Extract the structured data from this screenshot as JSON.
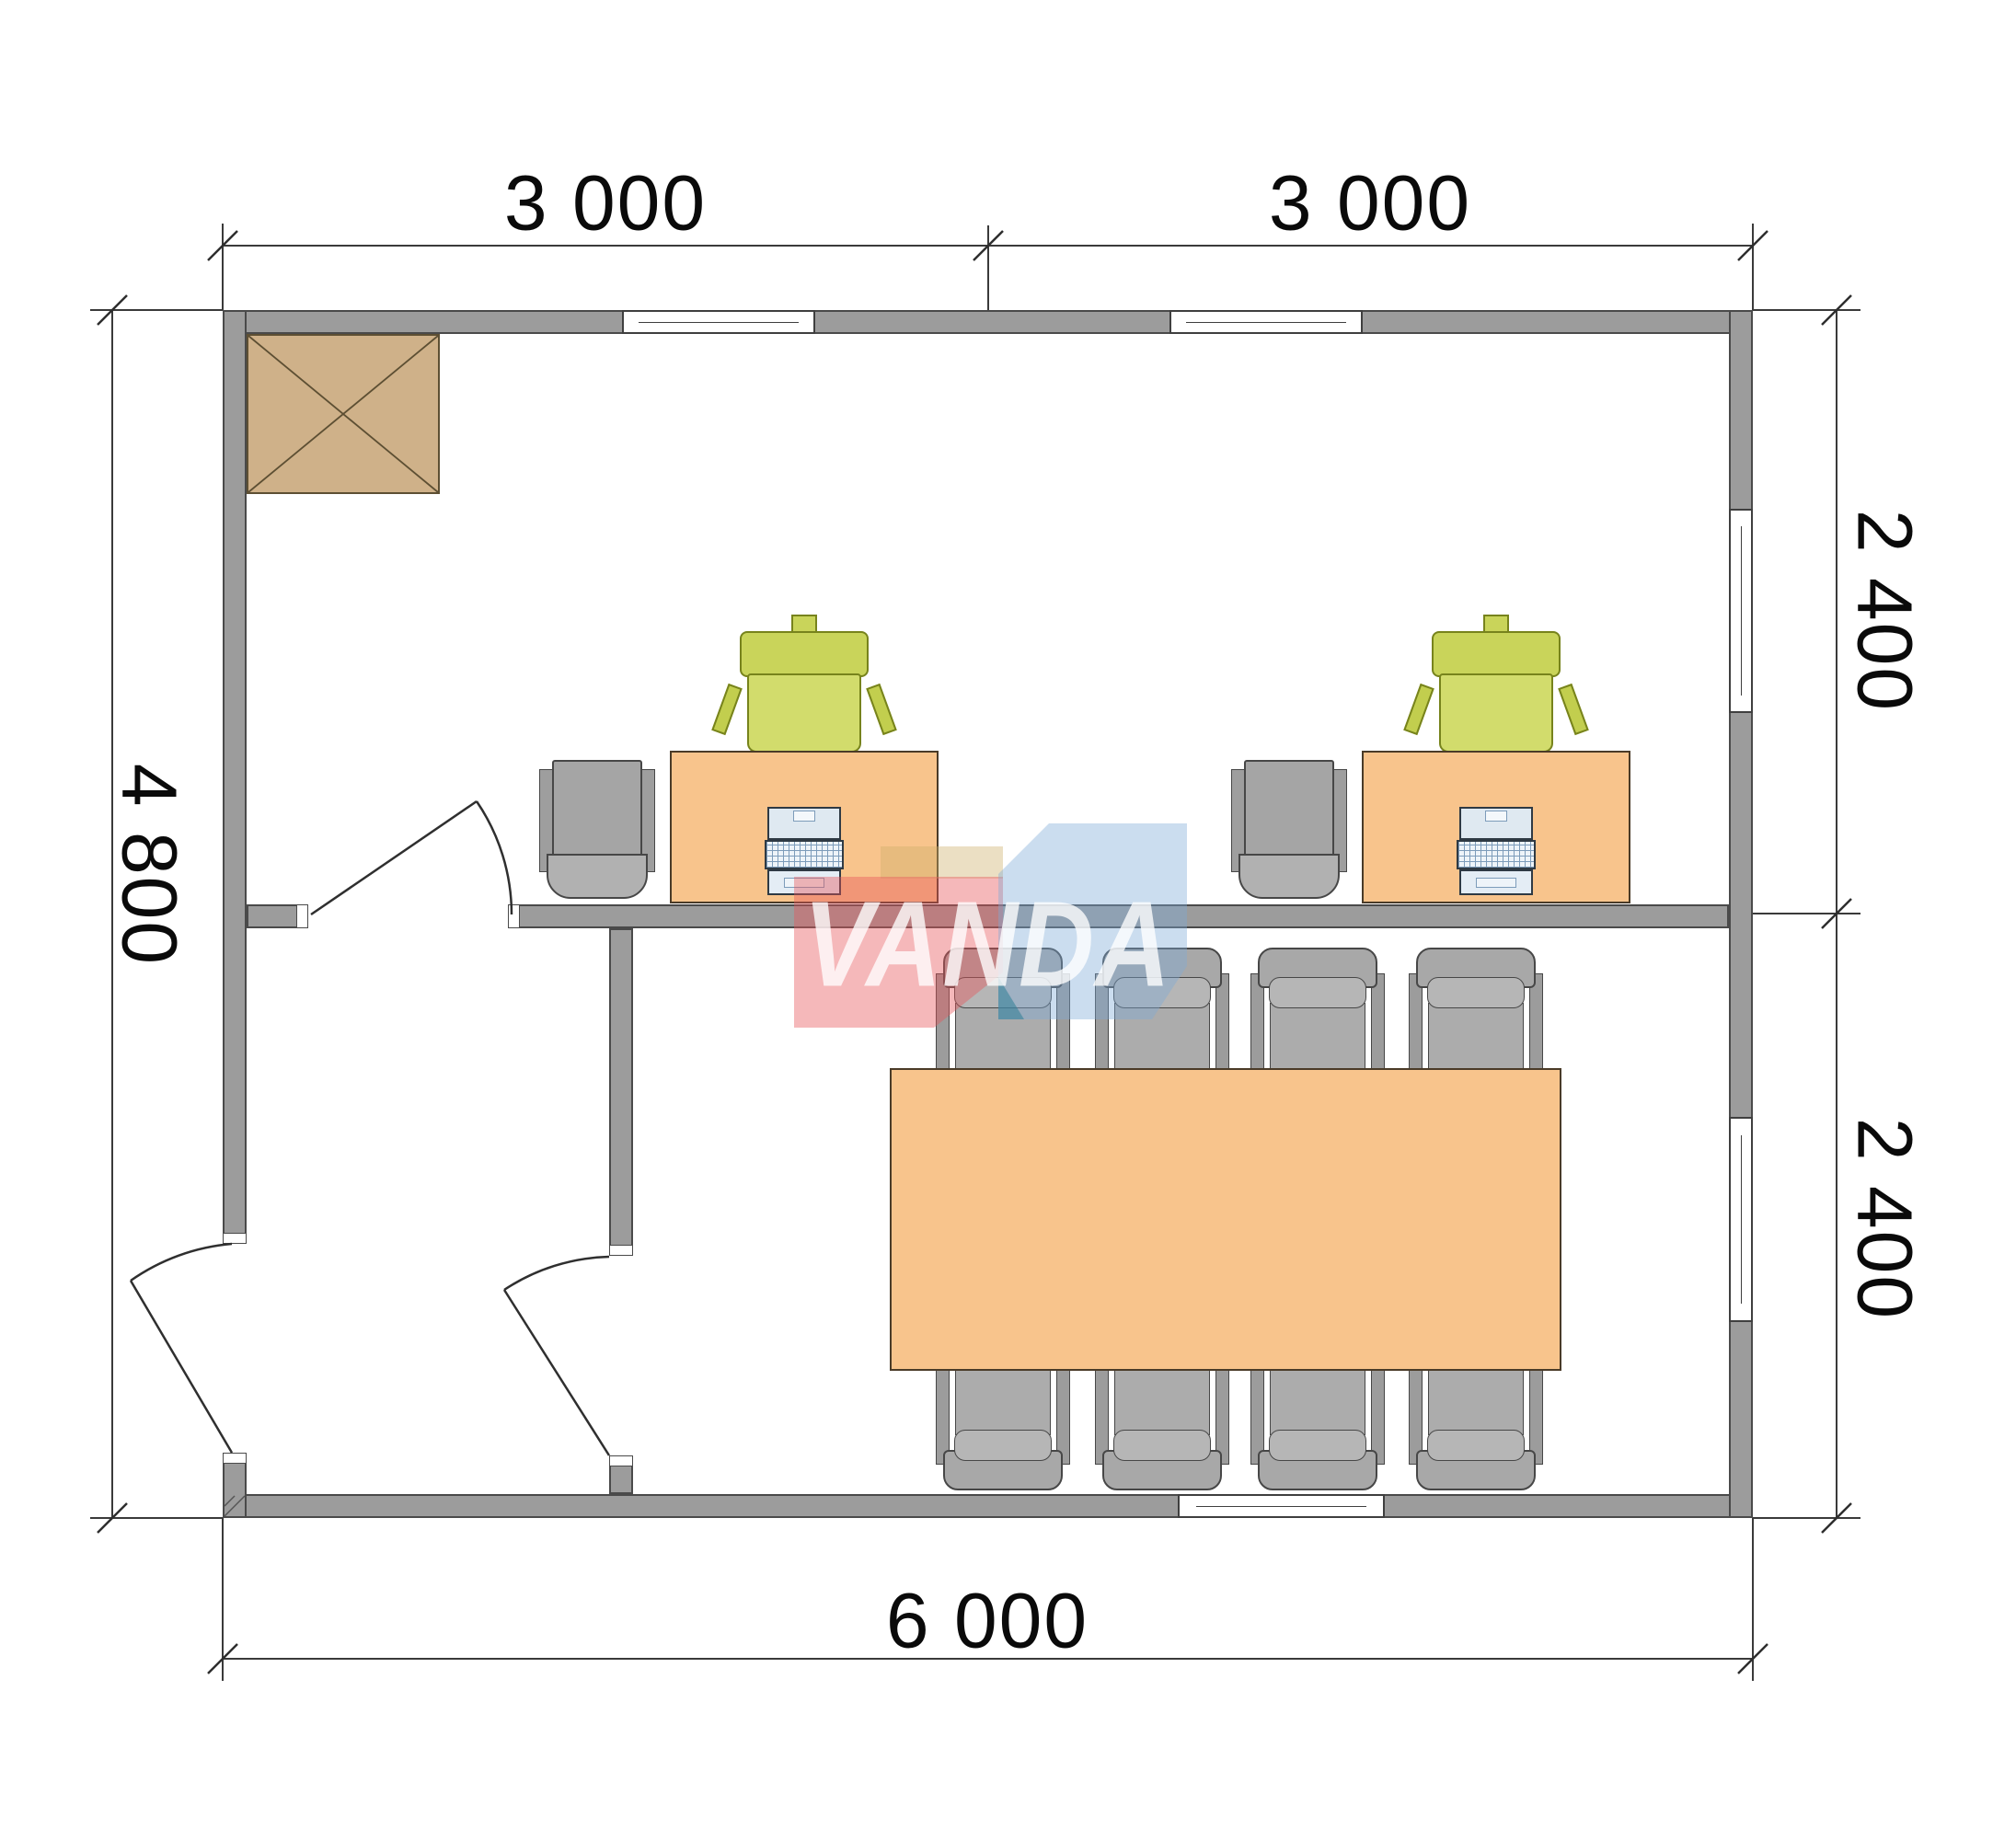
{
  "watermark": {
    "text": "VANDA",
    "red": "#e8555a",
    "blue": "#7da9d8",
    "teal": "#2e7d96"
  },
  "dims": {
    "top": [
      {
        "label": "3 000"
      },
      {
        "label": "3 000"
      }
    ],
    "right": [
      {
        "label": "2 400"
      },
      {
        "label": "2 400"
      }
    ],
    "left": [
      {
        "label": "4 800"
      }
    ],
    "bottom": [
      {
        "label": "6 000"
      }
    ]
  },
  "colors": {
    "wall": "#9c9c9c",
    "wall_edge": "#4a4a4a",
    "desk_and_table": "#f8c48c",
    "desk_chair_green": "#c9d45a",
    "cabinet_tan": "#cfb189",
    "gray_furniture": "#a8a8a8",
    "line": "#3a3a3a"
  },
  "furniture_inventory": {
    "desks": 2,
    "desk_chairs_green": 2,
    "visitor_chairs_gray": 2,
    "laptops": 2,
    "meeting_table": 1,
    "meeting_chairs": 8,
    "cabinet": 1,
    "doors": 3,
    "windows": 5
  }
}
